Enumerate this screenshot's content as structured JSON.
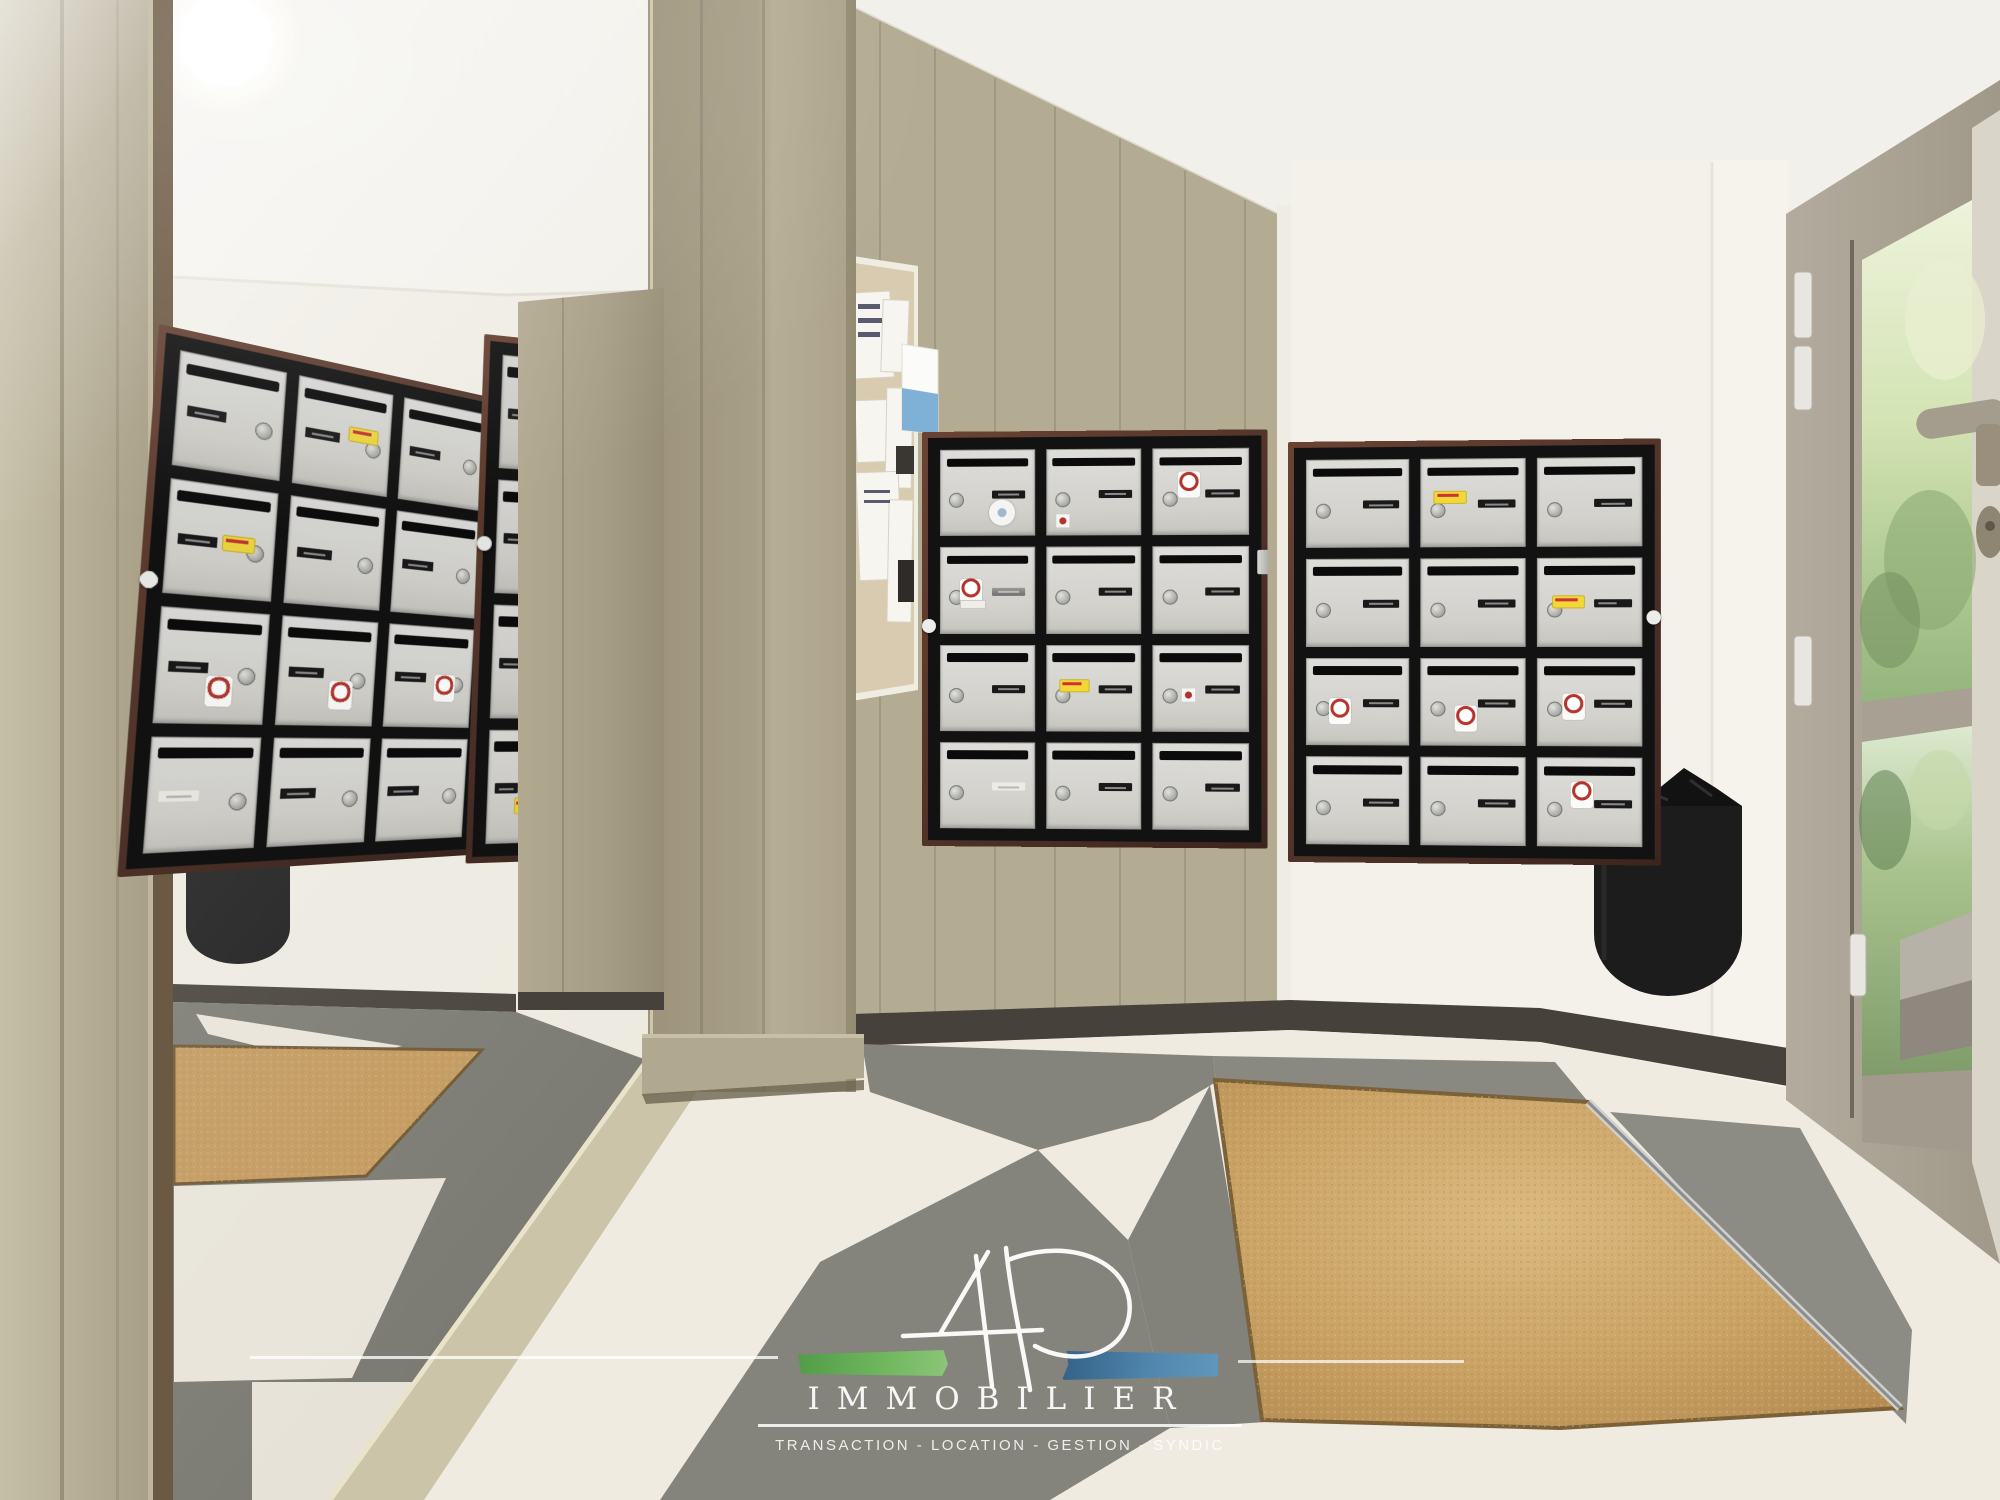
{
  "scene": {
    "type": "photograph",
    "setting": "apartment building entrance hall with mailbox banks, wall mirror, checkered tile floor, recessed coir doormat and glazed entrance door",
    "elements": [
      "wall-mirror",
      "beige-paneled-column",
      "notice-board",
      "mailbox-bank-center",
      "mailbox-bank-right",
      "wall-trash-bin",
      "glass-entrance-door",
      "coir-doormat",
      "checkered-floor",
      "agency-watermark"
    ]
  },
  "palette": {
    "wall_white": "#f3f0e9",
    "panel_beige": "#b4ab93",
    "column_beige": "#a89f87",
    "mailbox_door": "#d7d6d2",
    "mailbox_frame": "#121212",
    "mailbox_trim_brown": "#4f3228",
    "floor_white": "#efebe0",
    "floor_gray": "#85847c",
    "doormat_tan": "#c9a164",
    "baseboard_dark": "#46413a",
    "door_frame_greige": "#a9a193",
    "foliage_green": "#9dbd85",
    "bin_black": "#1c1c1c",
    "watermark_white": "#ffffff",
    "watermark_green": "#5aa24a",
    "watermark_blue": "#3f76a0",
    "sticker_yellow": "#f1d838",
    "sticker_red": "#b5332c"
  },
  "watermark": {
    "monogram": "4P",
    "brand": "IMMOBILIER",
    "tagline": "TRANSACTION - LOCATION - GESTION - SYNDIC"
  },
  "mailbox_banks": {
    "bank1": {
      "name": "mailbox-bank-center",
      "rows": 4,
      "cols": 3,
      "mirrored": false,
      "boxes": [
        [
          {
            "stickers": [
              {
                "type": "viewer",
                "x": 52,
                "y": 58
              }
            ]
          },
          {
            "stickers": [
              {
                "type": "mini",
                "x": 10,
                "y": 76
              }
            ]
          },
          {
            "stickers": [
              {
                "type": "stop",
                "x": 26,
                "y": 26
              }
            ]
          }
        ],
        [
          {
            "plate": "shiny",
            "stickers": [
              {
                "type": "stop",
                "x": 20,
                "y": 36
              },
              {
                "type": "lbl",
                "x": 20,
                "y": 62
              }
            ]
          },
          {},
          {}
        ],
        [
          {},
          {
            "stickers": [
              {
                "type": "oui",
                "x": 13,
                "y": 40
              }
            ]
          },
          {
            "stickers": [
              {
                "type": "mini",
                "x": 30,
                "y": 50
              }
            ]
          }
        ],
        [
          {
            "plate": "white"
          },
          {},
          {}
        ]
      ],
      "extras": {
        "knob_left_pct": 45,
        "latch_right_pct": 28
      }
    },
    "bank2": {
      "name": "mailbox-bank-right",
      "rows": 4,
      "cols": 3,
      "mirrored": false,
      "boxes": [
        [
          {},
          {
            "stickers": [
              {
                "type": "oui",
                "x": 12,
                "y": 36
              }
            ]
          },
          {}
        ],
        [
          {},
          {},
          {
            "plate": "split",
            "stickers": [
              {
                "type": "oui",
                "x": 14,
                "y": 42
              }
            ]
          }
        ],
        [
          {
            "stickers": [
              {
                "type": "stop",
                "x": 22,
                "y": 46
              }
            ]
          },
          {
            "stickers": [
              {
                "type": "stop",
                "x": 32,
                "y": 54
              }
            ]
          },
          {
            "stickers": [
              {
                "type": "stop",
                "x": 24,
                "y": 40
              }
            ]
          }
        ],
        [
          {},
          {},
          {
            "stickers": [
              {
                "type": "stop",
                "x": 32,
                "y": 26
              }
            ]
          }
        ]
      ],
      "extras": {
        "knob_right_pct": 40
      }
    },
    "bankA": {
      "name": "mirror-reflection-mailbox-bank",
      "rows": 4,
      "cols": 3,
      "mirrored": true,
      "boxes": [
        [
          {},
          {
            "stickers": [
              {
                "type": "oui",
                "x": 55,
                "y": 38
              }
            ]
          },
          {}
        ],
        [
          {
            "stickers": [
              {
                "type": "oui",
                "x": 50,
                "y": 44
              }
            ]
          },
          {},
          {}
        ],
        [
          {
            "stickers": [
              {
                "type": "stop",
                "x": 44,
                "y": 58
              }
            ]
          },
          {
            "stickers": [
              {
                "type": "stop",
                "x": 52,
                "y": 58
              }
            ]
          },
          {
            "stickers": [
              {
                "type": "stop",
                "x": 56,
                "y": 48
              }
            ]
          }
        ],
        [
          {
            "plate": "white"
          },
          {},
          {}
        ]
      ],
      "extras": {
        "knob_left_pct": 45
      }
    },
    "bankB": {
      "name": "mirror-reflection-mailbox-bank-partial",
      "rows": 4,
      "cols": 2,
      "mirrored": true,
      "boxes": [
        [
          {},
          {}
        ],
        [
          {
            "stickers": [
              {
                "type": "stop",
                "x": 48,
                "y": 40
              }
            ]
          },
          {}
        ],
        [
          {},
          {}
        ],
        [
          {
            "stickers": [
              {
                "type": "oui",
                "x": 40,
                "y": 60
              }
            ]
          },
          {}
        ]
      ],
      "extras": {
        "knob_left_pct": 38
      }
    }
  },
  "notice_board": {
    "papers": 6,
    "poster_blue": 1,
    "dark_notices": 2
  },
  "door": {
    "hinges": 4,
    "handle": "lever-left",
    "panes": 2,
    "view": "green foliage and concrete parapet"
  },
  "bins": {
    "real": 1,
    "reflected": 1
  },
  "floor": {
    "pattern": "diagonal white and gray tiles",
    "doormat": "recessed tan coir mat with metal edge strip"
  }
}
